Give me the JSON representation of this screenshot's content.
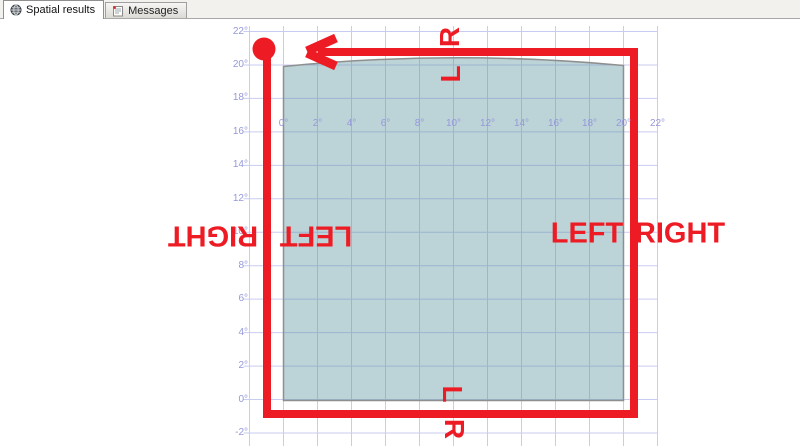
{
  "tab_bar": {
    "tabs": [
      {
        "label": "Spatial results",
        "icon": "globe-icon",
        "active": true
      },
      {
        "label": "Messages",
        "icon": "messages-icon",
        "active": false
      }
    ]
  },
  "spatial_view": {
    "x_axis_labels": [
      "0°",
      "2°",
      "4°",
      "6°",
      "8°",
      "10°",
      "12°",
      "14°",
      "16°",
      "18°",
      "20°",
      "22°"
    ],
    "y_axis_labels": [
      "22°",
      "20°",
      "18°",
      "16°",
      "14°",
      "12°",
      "10°",
      "8°",
      "6°",
      "4°",
      "2°",
      "0°",
      "-2°"
    ],
    "path_labels": {
      "top_outside": "R",
      "top_inside": "L",
      "right_inside": "LEFT",
      "right_outside": "RIGHT",
      "left_outside": "RIGHT",
      "left_inside": "LEFT",
      "bottom_inside": "L",
      "bottom_outside": "R"
    },
    "colors": {
      "overlay_red": "#ed1c24",
      "polygon_fill": "rgba(95,150,163,0.42)",
      "polygon_stroke": "#8f8f8f",
      "grid_line": "#c9ccf2",
      "axis_text": "#9598db"
    }
  },
  "chart_data": {
    "type": "spatial-map",
    "x_axis": {
      "tick_labels_deg": [
        0,
        2,
        4,
        6,
        8,
        10,
        12,
        14,
        16,
        18,
        20,
        22
      ],
      "visible_range_deg": [
        -2,
        22
      ]
    },
    "y_axis": {
      "tick_labels_deg": [
        22,
        20,
        18,
        16,
        14,
        12,
        10,
        8,
        6,
        4,
        2,
        0,
        -2
      ],
      "visible_range_deg": [
        -2,
        22
      ]
    },
    "polygon": {
      "shape": "square",
      "lon_range_deg": [
        0,
        20
      ],
      "lat_range_deg": [
        0,
        20
      ],
      "top_edge": "geodesic bulge up to ~20.5°"
    },
    "overlay_path": {
      "shape": "rectangle",
      "approx_lon_range_deg": [
        -1,
        20.7
      ],
      "approx_lat_range_deg": [
        -0.8,
        20.7
      ],
      "start_marker": "circle at top-left corner",
      "direction": "down left edge, right along bottom, up right edge, left along top",
      "arrow": "points left at end of top edge",
      "side_annotations": "L/LEFT marks left of travel, R/RIGHT marks right of travel"
    },
    "grid": true,
    "legend": false
  }
}
